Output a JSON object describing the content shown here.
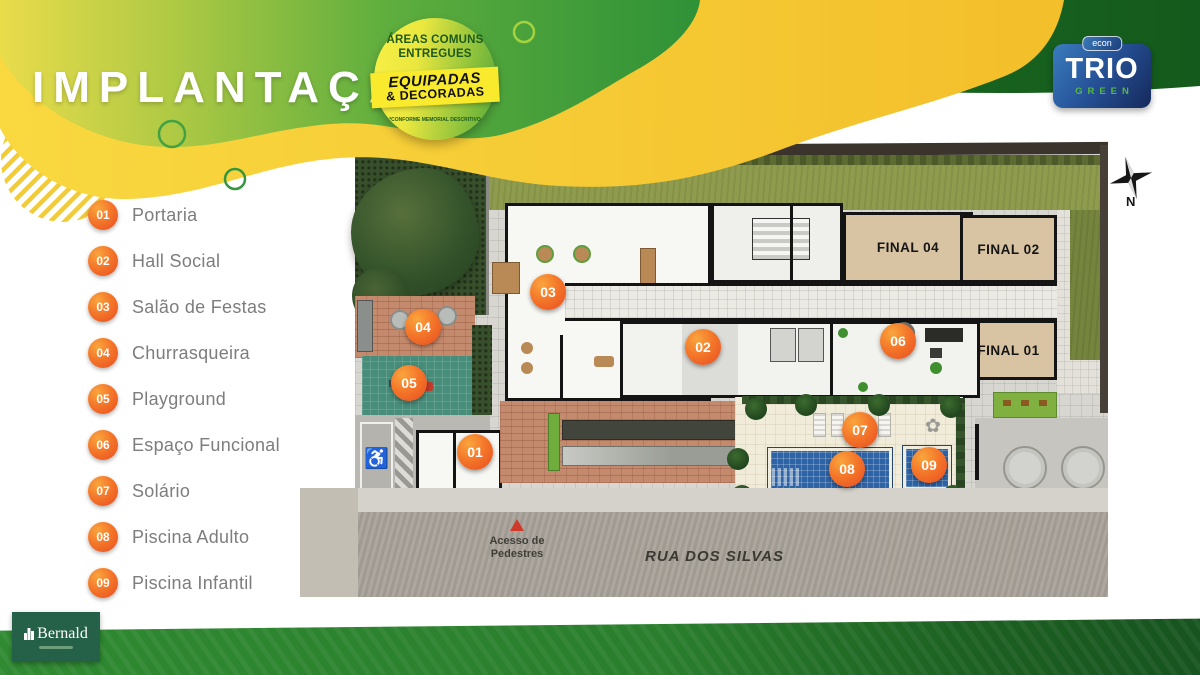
{
  "header": {
    "title": "IMPLANTAÇÃO",
    "badge": {
      "top1": "ÁREAS COMUNS",
      "top2": "ENTREGUES",
      "band1": "EQUIPADAS",
      "band2": "& DECORADAS",
      "disclaimer": "*CONFORME MEMORIAL DESCRITIVO"
    },
    "brand": {
      "tab": "econ",
      "name": "TRIO",
      "sub": "GREEN"
    }
  },
  "legend": {
    "items": [
      {
        "num": "01",
        "label": "Portaria"
      },
      {
        "num": "02",
        "label": "Hall Social"
      },
      {
        "num": "03",
        "label": "Salão de Festas"
      },
      {
        "num": "04",
        "label": "Churrasqueira"
      },
      {
        "num": "05",
        "label": "Playground"
      },
      {
        "num": "06",
        "label": "Espaço Funcional"
      },
      {
        "num": "07",
        "label": "Solário"
      },
      {
        "num": "08",
        "label": "Piscina Adulto"
      },
      {
        "num": "09",
        "label": "Piscina Infantil"
      }
    ]
  },
  "plan": {
    "units": [
      {
        "label": "FINAL 04"
      },
      {
        "label": "FINAL 02"
      },
      {
        "label": "FINAL 01"
      }
    ],
    "markers": [
      {
        "num": "01",
        "x": 475,
        "y": 452
      },
      {
        "num": "02",
        "x": 703,
        "y": 347
      },
      {
        "num": "03",
        "x": 548,
        "y": 292
      },
      {
        "num": "04",
        "x": 423,
        "y": 327
      },
      {
        "num": "05",
        "x": 409,
        "y": 383
      },
      {
        "num": "06",
        "x": 898,
        "y": 341
      },
      {
        "num": "07",
        "x": 860,
        "y": 430
      },
      {
        "num": "08",
        "x": 847,
        "y": 469
      },
      {
        "num": "09",
        "x": 929,
        "y": 465
      }
    ],
    "street_name": "RUA DOS SILVAS",
    "access_label": "Acesso de Pedestres",
    "compass": "N"
  },
  "footer": {
    "logo": "Bernald"
  },
  "colors": {
    "accent_orange": "#f4772a",
    "brand_green": "#2f9137",
    "dark_green_band": "#1d6b24",
    "logo_navy": "#16305f",
    "badge_yellow": "#f9ea2e"
  }
}
